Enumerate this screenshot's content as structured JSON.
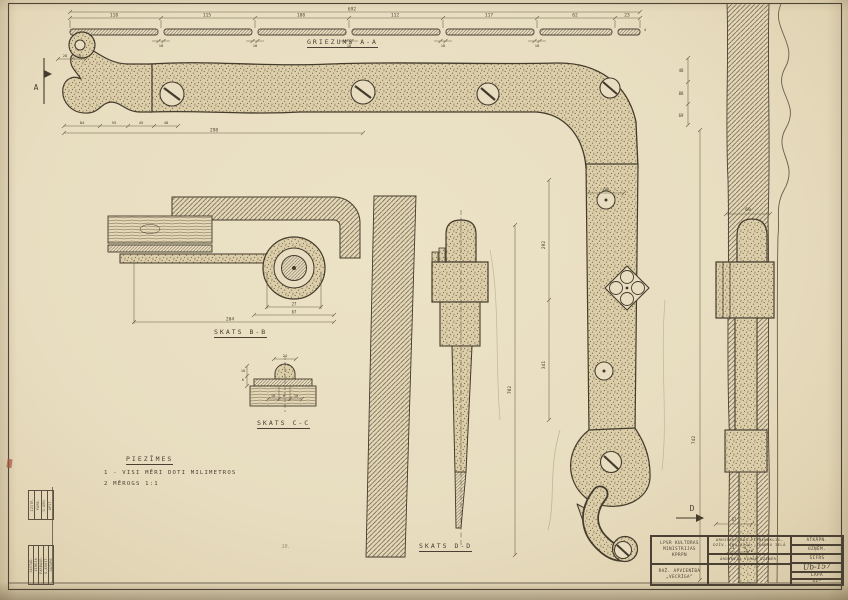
{
  "colors": {
    "paper": "#e8ddc0",
    "ink": "#4a4134",
    "dim": "#6a5e48",
    "pencil": "#9c8e74",
    "red_mark": "#a8523e"
  },
  "labels": {
    "section_aa": "GRIEZUMS A-A",
    "view_bb": "SKATS B-B",
    "view_cc": "SKATS C-C",
    "view_dd": "SKATS D-D"
  },
  "notes": {
    "heading": "PIEZĪMES",
    "items": [
      "1 - VISI MĒRI DOTI MILIMETROS",
      "2   MĒROGS 1:1"
    ]
  },
  "title_block": {
    "org": [
      "LPSR KULTŪRAS",
      "MINISTRIJAS",
      "KPRPN"
    ],
    "org2": [
      "RAŽ. APVIENĪBA",
      "„VECRĪGA”"
    ],
    "object": [
      "ARHITEKTŪRAS PIEMINEKLIS—",
      "DZĪV. ĒKA RĪGĀ, SKĀRŅU IELĀ 4/6"
    ],
    "part": "ĀRDURVJU VIRAS DZINĒR.",
    "rows": [
      {
        "label": "ATKĀPN."
      },
      {
        "label": "UZŅĒM."
      },
      {
        "label": "ŠIFRS"
      },
      {
        "label": "Ub-157"
      },
      {
        "label": "LAPA"
      },
      {
        "label": "UZ—"
      }
    ]
  },
  "stamps": {
    "block1": [
      "IZSTR.",
      "PĀRB.",
      "G.ARH.",
      "APST."
    ],
    "block2": [
      "SASTĀD.",
      "ZĪMĒJA",
      "PĀRBAUD.",
      "G.ARHIT.",
      "DATUMS"
    ]
  },
  "markers": [
    {
      "t": "A",
      "x": 36,
      "y": 90
    },
    {
      "t": "D",
      "x": 692,
      "y": 511
    }
  ],
  "pencil_note": {
    "t": "10.",
    "x": 286,
    "y": 548
  },
  "dims": [
    {
      "t": "692",
      "x": 352,
      "y": 10.5
    },
    {
      "t": "118",
      "x": 114,
      "y": 16.5
    },
    {
      "t": "115",
      "x": 207,
      "y": 16.5
    },
    {
      "t": "108",
      "x": 301,
      "y": 16.5
    },
    {
      "t": "112",
      "x": 395,
      "y": 16.5
    },
    {
      "t": "117",
      "x": 489,
      "y": 16.5
    },
    {
      "t": "62",
      "x": 575,
      "y": 16.5
    },
    {
      "t": "23",
      "x": 627,
      "y": 16.5
    },
    {
      "t": "18",
      "x": 161,
      "y": 47,
      "s": 3.8
    },
    {
      "t": "18",
      "x": 255,
      "y": 47,
      "s": 3.8
    },
    {
      "t": "18",
      "x": 349,
      "y": 47,
      "s": 3.8
    },
    {
      "t": "18",
      "x": 443,
      "y": 47,
      "s": 3.8
    },
    {
      "t": "18",
      "x": 537,
      "y": 47,
      "s": 3.8
    },
    {
      "t": "4",
      "x": 645,
      "y": 31,
      "s": 3.8
    },
    {
      "t": "28",
      "x": 65,
      "y": 57,
      "s": 3.8
    },
    {
      "t": "18",
      "x": 79,
      "y": 57,
      "s": 3.8
    },
    {
      "t": "84",
      "x": 82,
      "y": 124,
      "s": 3.8
    },
    {
      "t": "55",
      "x": 114,
      "y": 124,
      "s": 3.8
    },
    {
      "t": "45",
      "x": 141,
      "y": 124,
      "s": 3.8
    },
    {
      "t": "48",
      "x": 166,
      "y": 124,
      "s": 3.8
    },
    {
      "t": "298",
      "x": 214,
      "y": 131.5
    },
    {
      "t": "48",
      "x": 681,
      "y": 72,
      "s": 4
    },
    {
      "t": "88",
      "x": 681,
      "y": 95,
      "s": 4
    },
    {
      "t": "69",
      "x": 681,
      "y": 117,
      "s": 4
    },
    {
      "t": "292",
      "x": 545,
      "y": 245,
      "r": -90
    },
    {
      "t": "341",
      "x": 545,
      "y": 365,
      "r": -90
    },
    {
      "t": "742",
      "x": 695,
      "y": 440,
      "r": -90
    },
    {
      "t": "702",
      "x": 511,
      "y": 390,
      "r": -90
    },
    {
      "t": "60",
      "x": 606,
      "y": 191
    },
    {
      "t": "69",
      "x": 748,
      "y": 211
    },
    {
      "t": "67",
      "x": 734,
      "y": 521,
      "s": 4
    },
    {
      "t": "23",
      "x": 732,
      "y": 549,
      "s": 3.8
    },
    {
      "t": "8",
      "x": 745,
      "y": 549,
      "s": 3.8
    },
    {
      "t": "27",
      "x": 294,
      "y": 305.5,
      "s": 4
    },
    {
      "t": "67",
      "x": 294,
      "y": 313.5,
      "s": 4
    },
    {
      "t": "204",
      "x": 230,
      "y": 320.5
    },
    {
      "t": "24",
      "x": 285,
      "y": 357,
      "s": 3.8
    },
    {
      "t": "10",
      "x": 273,
      "y": 397,
      "s": 3.6
    },
    {
      "t": "8",
      "x": 284,
      "y": 397,
      "s": 3.6
    },
    {
      "t": "10",
      "x": 296,
      "y": 397,
      "s": 3.6
    },
    {
      "t": "10",
      "x": 243,
      "y": 372,
      "s": 3.6
    },
    {
      "t": "6",
      "x": 243,
      "y": 381,
      "s": 3.6
    }
  ]
}
